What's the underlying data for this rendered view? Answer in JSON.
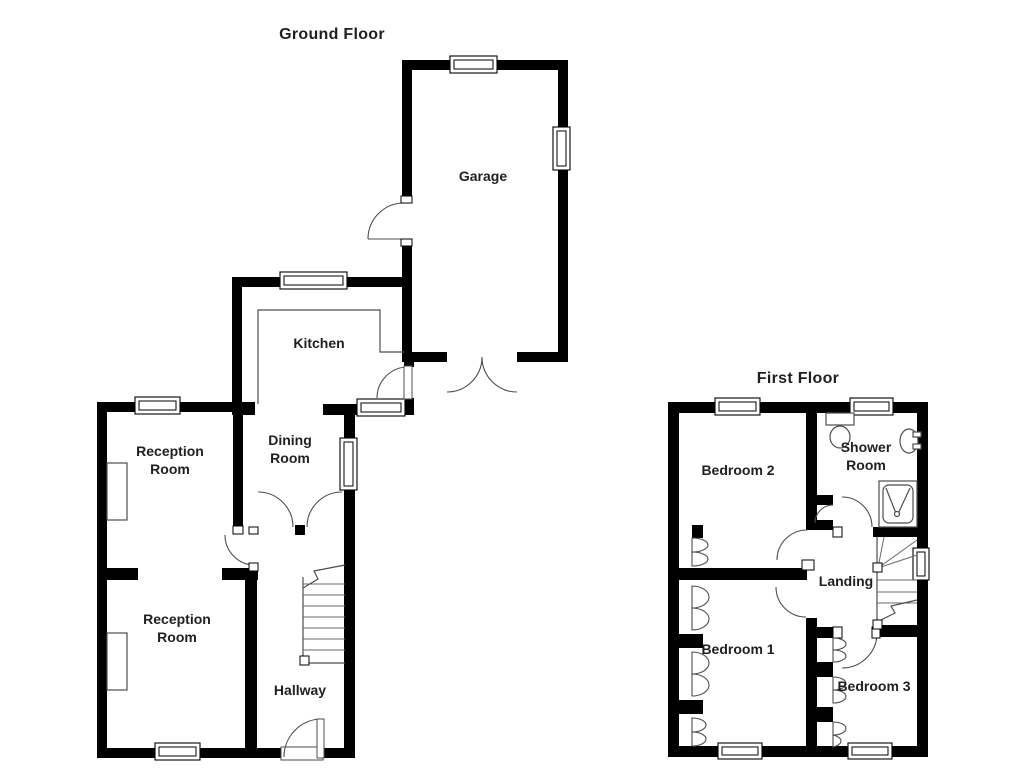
{
  "document_type": "floorplan",
  "colors": {
    "wall": "#000000",
    "thin_line": "#4d4d4d",
    "label_text": "#1f1f1f",
    "background": "#ffffff"
  },
  "ground_floor": {
    "title": "Ground Floor",
    "rooms": {
      "garage": "Garage",
      "kitchen": "Kitchen",
      "dining": [
        "Dining",
        "Room"
      ],
      "reception1": [
        "Reception",
        "Room"
      ],
      "reception2": [
        "Reception",
        "Room"
      ],
      "hallway": "Hallway"
    }
  },
  "first_floor": {
    "title": "First Floor",
    "rooms": {
      "bedroom2": "Bedroom 2",
      "shower": [
        "Shower",
        "Room"
      ],
      "landing": "Landing",
      "bedroom1": "Bedroom 1",
      "bedroom3": "Bedroom 3"
    }
  }
}
